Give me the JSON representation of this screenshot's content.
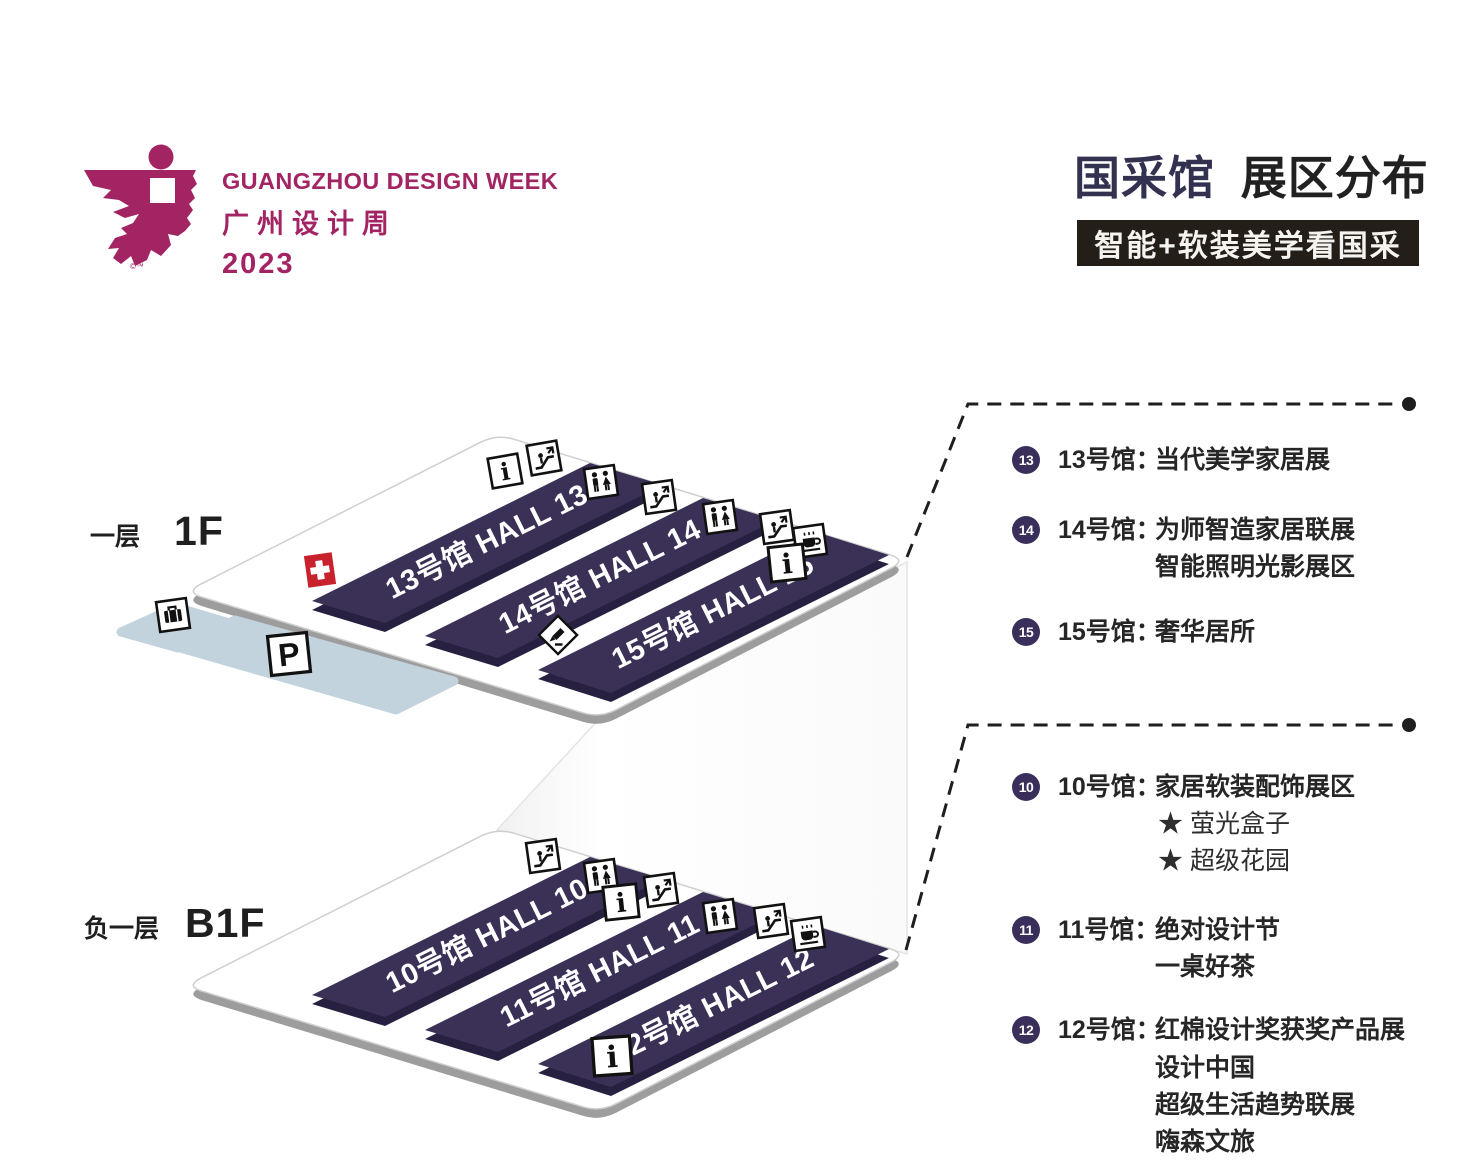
{
  "meta": {
    "description": "Guangzhou Design Week 2023 Guocai hall exhibition-area distribution map"
  },
  "colors": {
    "brand_magenta": "#A32463",
    "hall_navy_top": "#3B3157",
    "hall_navy_side": "#272040",
    "legend_circle": "#3A2F5A",
    "title_navy": "#333150",
    "ink": "#1F1F1F",
    "subtitle_box_bg": "#241E19",
    "parking_blue": "#C2D3DE",
    "first_aid_red": "#C8232C",
    "platform_white": "#FFFFFF",
    "platform_shadow": "#9D9D9D"
  },
  "logo": {
    "brand_en": "GUANGZHOU DESIGN WEEK",
    "brand_cn": "广州设计周",
    "year": "2023",
    "trademark": "©™"
  },
  "header": {
    "title_hall": "国采馆",
    "title_rest": "展区分布",
    "subtitle": "智能+软装美学看国采"
  },
  "floors": [
    {
      "label_cn": "一层",
      "label_code": "1F",
      "halls": [
        {
          "label": "13号馆 HALL 13"
        },
        {
          "label": "14号馆 HALL 14"
        },
        {
          "label": "15号馆 HALL 15"
        }
      ]
    },
    {
      "label_cn": "负一层",
      "label_code": "B1F",
      "halls": [
        {
          "label": "10号馆 HALL 10"
        },
        {
          "label": "11号馆 HALL 11"
        },
        {
          "label": "12号馆 HALL 12"
        }
      ]
    }
  ],
  "map_icons": {
    "info_glyph": "i",
    "parking_glyph": "P",
    "types": [
      "info-icon",
      "escalator-icon",
      "restroom-icon",
      "coffee-icon",
      "first-aid-icon",
      "pen-icon",
      "luggage-icon",
      "parking-icon"
    ]
  },
  "legend": {
    "groups": [
      {
        "items": [
          {
            "num": "13",
            "title": "13号馆：",
            "lines": [
              "当代美学家居展"
            ]
          },
          {
            "num": "14",
            "title": "14号馆：",
            "lines": [
              "为师智造家居联展",
              "智能照明光影展区"
            ]
          },
          {
            "num": "15",
            "title": "15号馆：",
            "lines": [
              "奢华居所"
            ]
          }
        ]
      },
      {
        "items": [
          {
            "num": "10",
            "title": "10号馆：",
            "lines": [
              "家居软装配饰展区",
              "★ 萤光盒子",
              "★ 超级花园"
            ]
          },
          {
            "num": "11",
            "title": "11号馆：",
            "lines": [
              "绝对设计节",
              "一桌好茶"
            ]
          },
          {
            "num": "12",
            "title": "12号馆：",
            "lines": [
              "红棉设计奖获奖产品展",
              "设计中国",
              "超级生活趋势联展",
              "嗨森文旅"
            ]
          }
        ]
      }
    ]
  }
}
